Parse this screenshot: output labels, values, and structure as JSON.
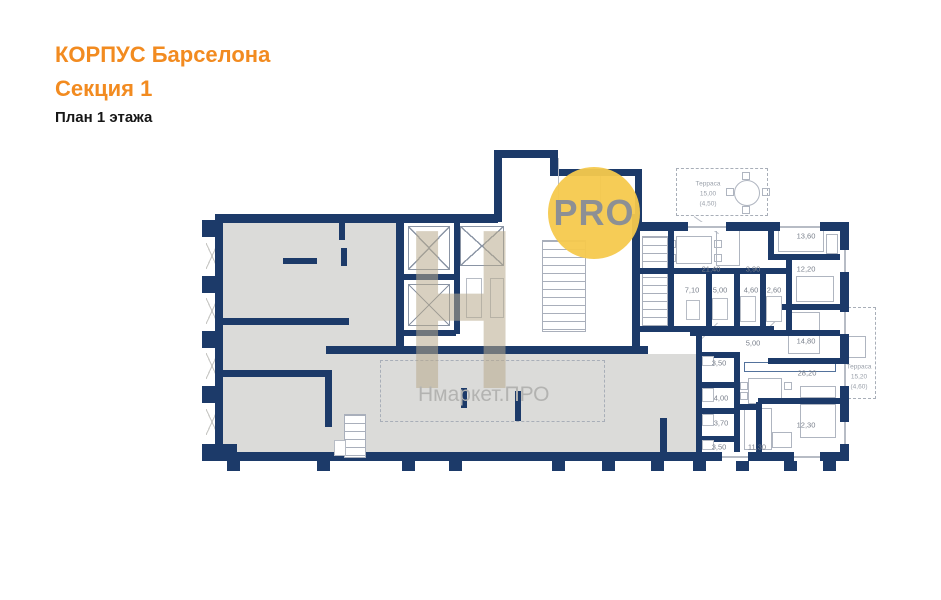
{
  "title": {
    "building": "КОРПУС Барселона",
    "section": "Секция 1",
    "floor_plan": "План 1 этажа"
  },
  "watermark": {
    "letter": "Н",
    "circle_text": "PRO",
    "brand_text": "Нмаркет.ПРО"
  },
  "colors": {
    "accent_orange": "#F28B20",
    "wall_navy": "#1C3A69",
    "commercial_fill_gray": "#DBDBD9",
    "watermark_yellow": "#F6C94D",
    "watermark_tan": "#B8A98D",
    "label_gray": "#7A808C"
  },
  "plan": {
    "room_labels": [
      {
        "text": "21,40",
        "x": 711,
        "y": 269
      },
      {
        "text": "3,90",
        "x": 753,
        "y": 269
      },
      {
        "text": "13,60",
        "x": 806,
        "y": 236
      },
      {
        "text": "12,20",
        "x": 806,
        "y": 269
      },
      {
        "text": "7,10",
        "x": 692,
        "y": 290
      },
      {
        "text": "5,00",
        "x": 720,
        "y": 290
      },
      {
        "text": "4,60",
        "x": 751,
        "y": 290
      },
      {
        "text": "2,60",
        "x": 774,
        "y": 290
      },
      {
        "text": "5,00",
        "x": 753,
        "y": 343
      },
      {
        "text": "14,80",
        "x": 806,
        "y": 341
      },
      {
        "text": "3,50",
        "x": 719,
        "y": 363
      },
      {
        "text": "28,20",
        "x": 807,
        "y": 373
      },
      {
        "text": "4,00",
        "x": 721,
        "y": 398
      },
      {
        "text": "3,70",
        "x": 721,
        "y": 423
      },
      {
        "text": "12,30",
        "x": 806,
        "y": 425
      },
      {
        "text": "3,50",
        "x": 719,
        "y": 447
      },
      {
        "text": "11,30",
        "x": 757,
        "y": 447
      }
    ],
    "terraces": [
      {
        "name": "Терраса",
        "area": "15,00",
        "reduced": "(4,50)"
      },
      {
        "name": "Терраса",
        "area": "15,20",
        "reduced": "(4,60)"
      }
    ]
  }
}
